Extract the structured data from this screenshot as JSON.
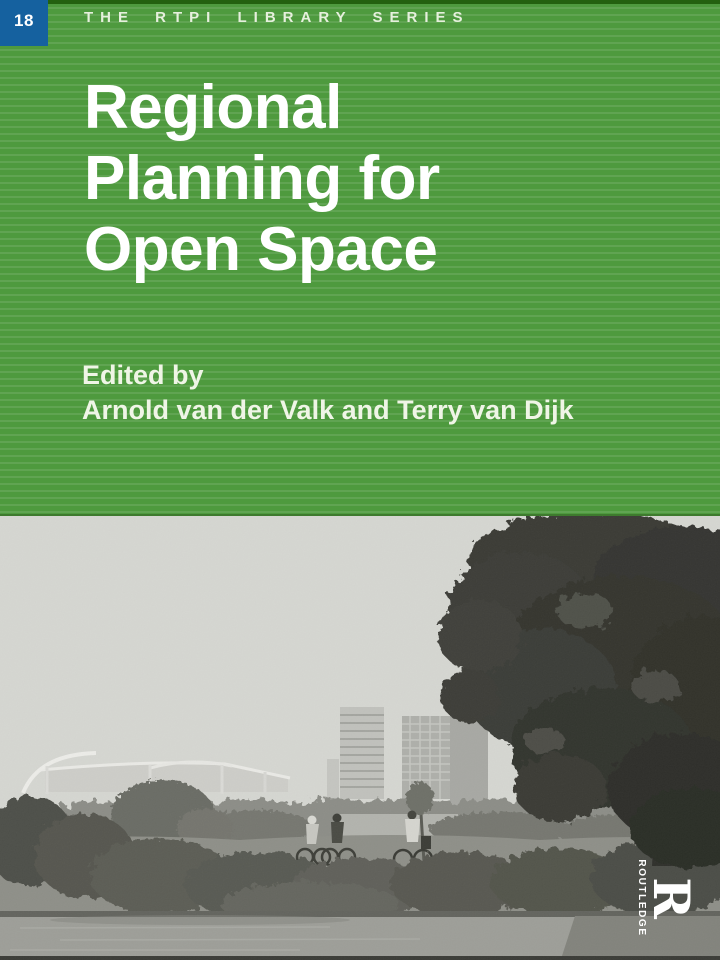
{
  "cover": {
    "series_badge": {
      "number": "18"
    },
    "series_title": "THE RTPI LIBRARY SERIES",
    "title": "Regional Planning for Open Space",
    "title_lines": [
      "Regional",
      "Planning for",
      "Open Space"
    ],
    "edited_by_label": "Edited by",
    "editors": "Arnold van der Valk and Terry van Dijk"
  },
  "publisher": {
    "name": "ROUTLEDGE",
    "initial": "R"
  },
  "photo": {
    "description": "Monochrome photograph of a lakeside park with reeds and cyclists on a bank, a large tree at right, and a stadium with high-rise towers on the horizon"
  },
  "colors": {
    "panel_green": "#4e9a3e",
    "badge_blue": "#15619f",
    "text_white": "#ffffff",
    "photo_sky": "#d5d6d1",
    "photo_water": "#9d9e98"
  }
}
